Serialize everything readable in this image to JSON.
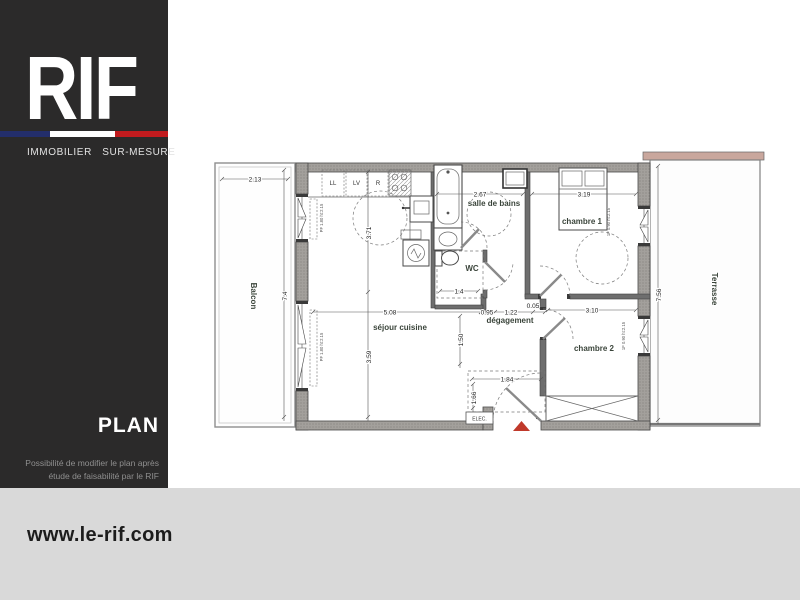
{
  "brand": {
    "logo_text": "RIF",
    "tagline": "IMMOBILIER SUR-MESURE",
    "flag_colors": {
      "blue": "#232e6b",
      "white": "#ffffff",
      "red": "#c11b1e"
    },
    "sidebar_background": "#2b2a2a"
  },
  "sidebar": {
    "section_title": "PLAN",
    "note_line1": "Possibilité de modifier le plan après",
    "note_line2": "étude de faisabilité par le RIF"
  },
  "footer": {
    "website": "www.le-rif.com",
    "background": "#d9d9d9"
  },
  "plan": {
    "rooms": {
      "balcon": "Balcon",
      "sejour": "séjour cuisine",
      "salle_de_bains": "salle de bains",
      "wc": "WC",
      "degagement": "dégagement",
      "chambre1": "chambre 1",
      "chambre2": "chambre 2",
      "terrasse": "Terrasse"
    },
    "appliances": {
      "ll": "LL",
      "lv": "LV",
      "r": "R"
    },
    "labels": {
      "elec": "ELEC."
    },
    "dimensions": {
      "balcon_width": "2.13",
      "balcon_height": "7.4",
      "sejour_width": "5.08",
      "sejour_height_top": "3.71",
      "sejour_height_bottom": "3.59",
      "bains_width": "2.67",
      "wc_width": "1.4",
      "chambre1_width": "3.19",
      "chambre2_width": "3.10",
      "terrasse_height": "7.56",
      "degagement_a": "0.95",
      "degagement_b": "1.22",
      "degagement_c": "0.05",
      "entree_width": "1.84",
      "entree_height": "1.66",
      "entree_depth": "1.50"
    },
    "window_notes": {
      "pf": "PF 1.80 ht:2.15",
      "f1": "1F 0.90 ht:2.15"
    },
    "entry_marker_color": "#c0392b",
    "terrace_wall_color": "#c9a79d"
  }
}
